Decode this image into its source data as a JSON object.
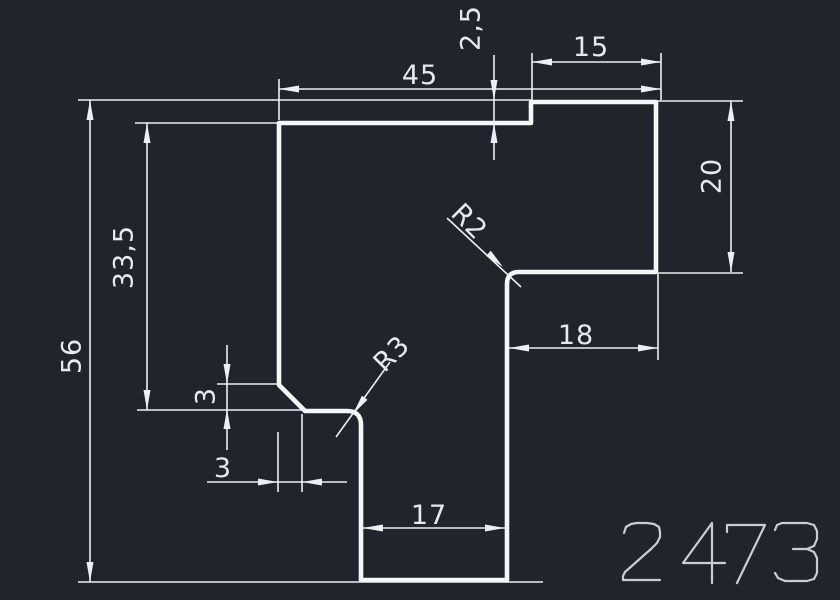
{
  "drawing": {
    "background_color": "#20242c",
    "profile_line_color": "#f4f6f8",
    "dimension_line_color": "#edf0f2",
    "dimension_text_color": "#e6eaed",
    "part_number": "2473",
    "part_number_color": "#c9ced4",
    "labels": {
      "total_width": "45",
      "top_right_width": "15",
      "step_height": "2,5",
      "total_height": "56",
      "upper_left_height": "33,5",
      "right_flange_height": "20",
      "inner_width": "18",
      "bottom_leg_width": "17",
      "chamfer_height": "3",
      "chamfer_width": "3",
      "corner_radius_inner": "R2",
      "corner_radius_outer": "R3"
    }
  }
}
